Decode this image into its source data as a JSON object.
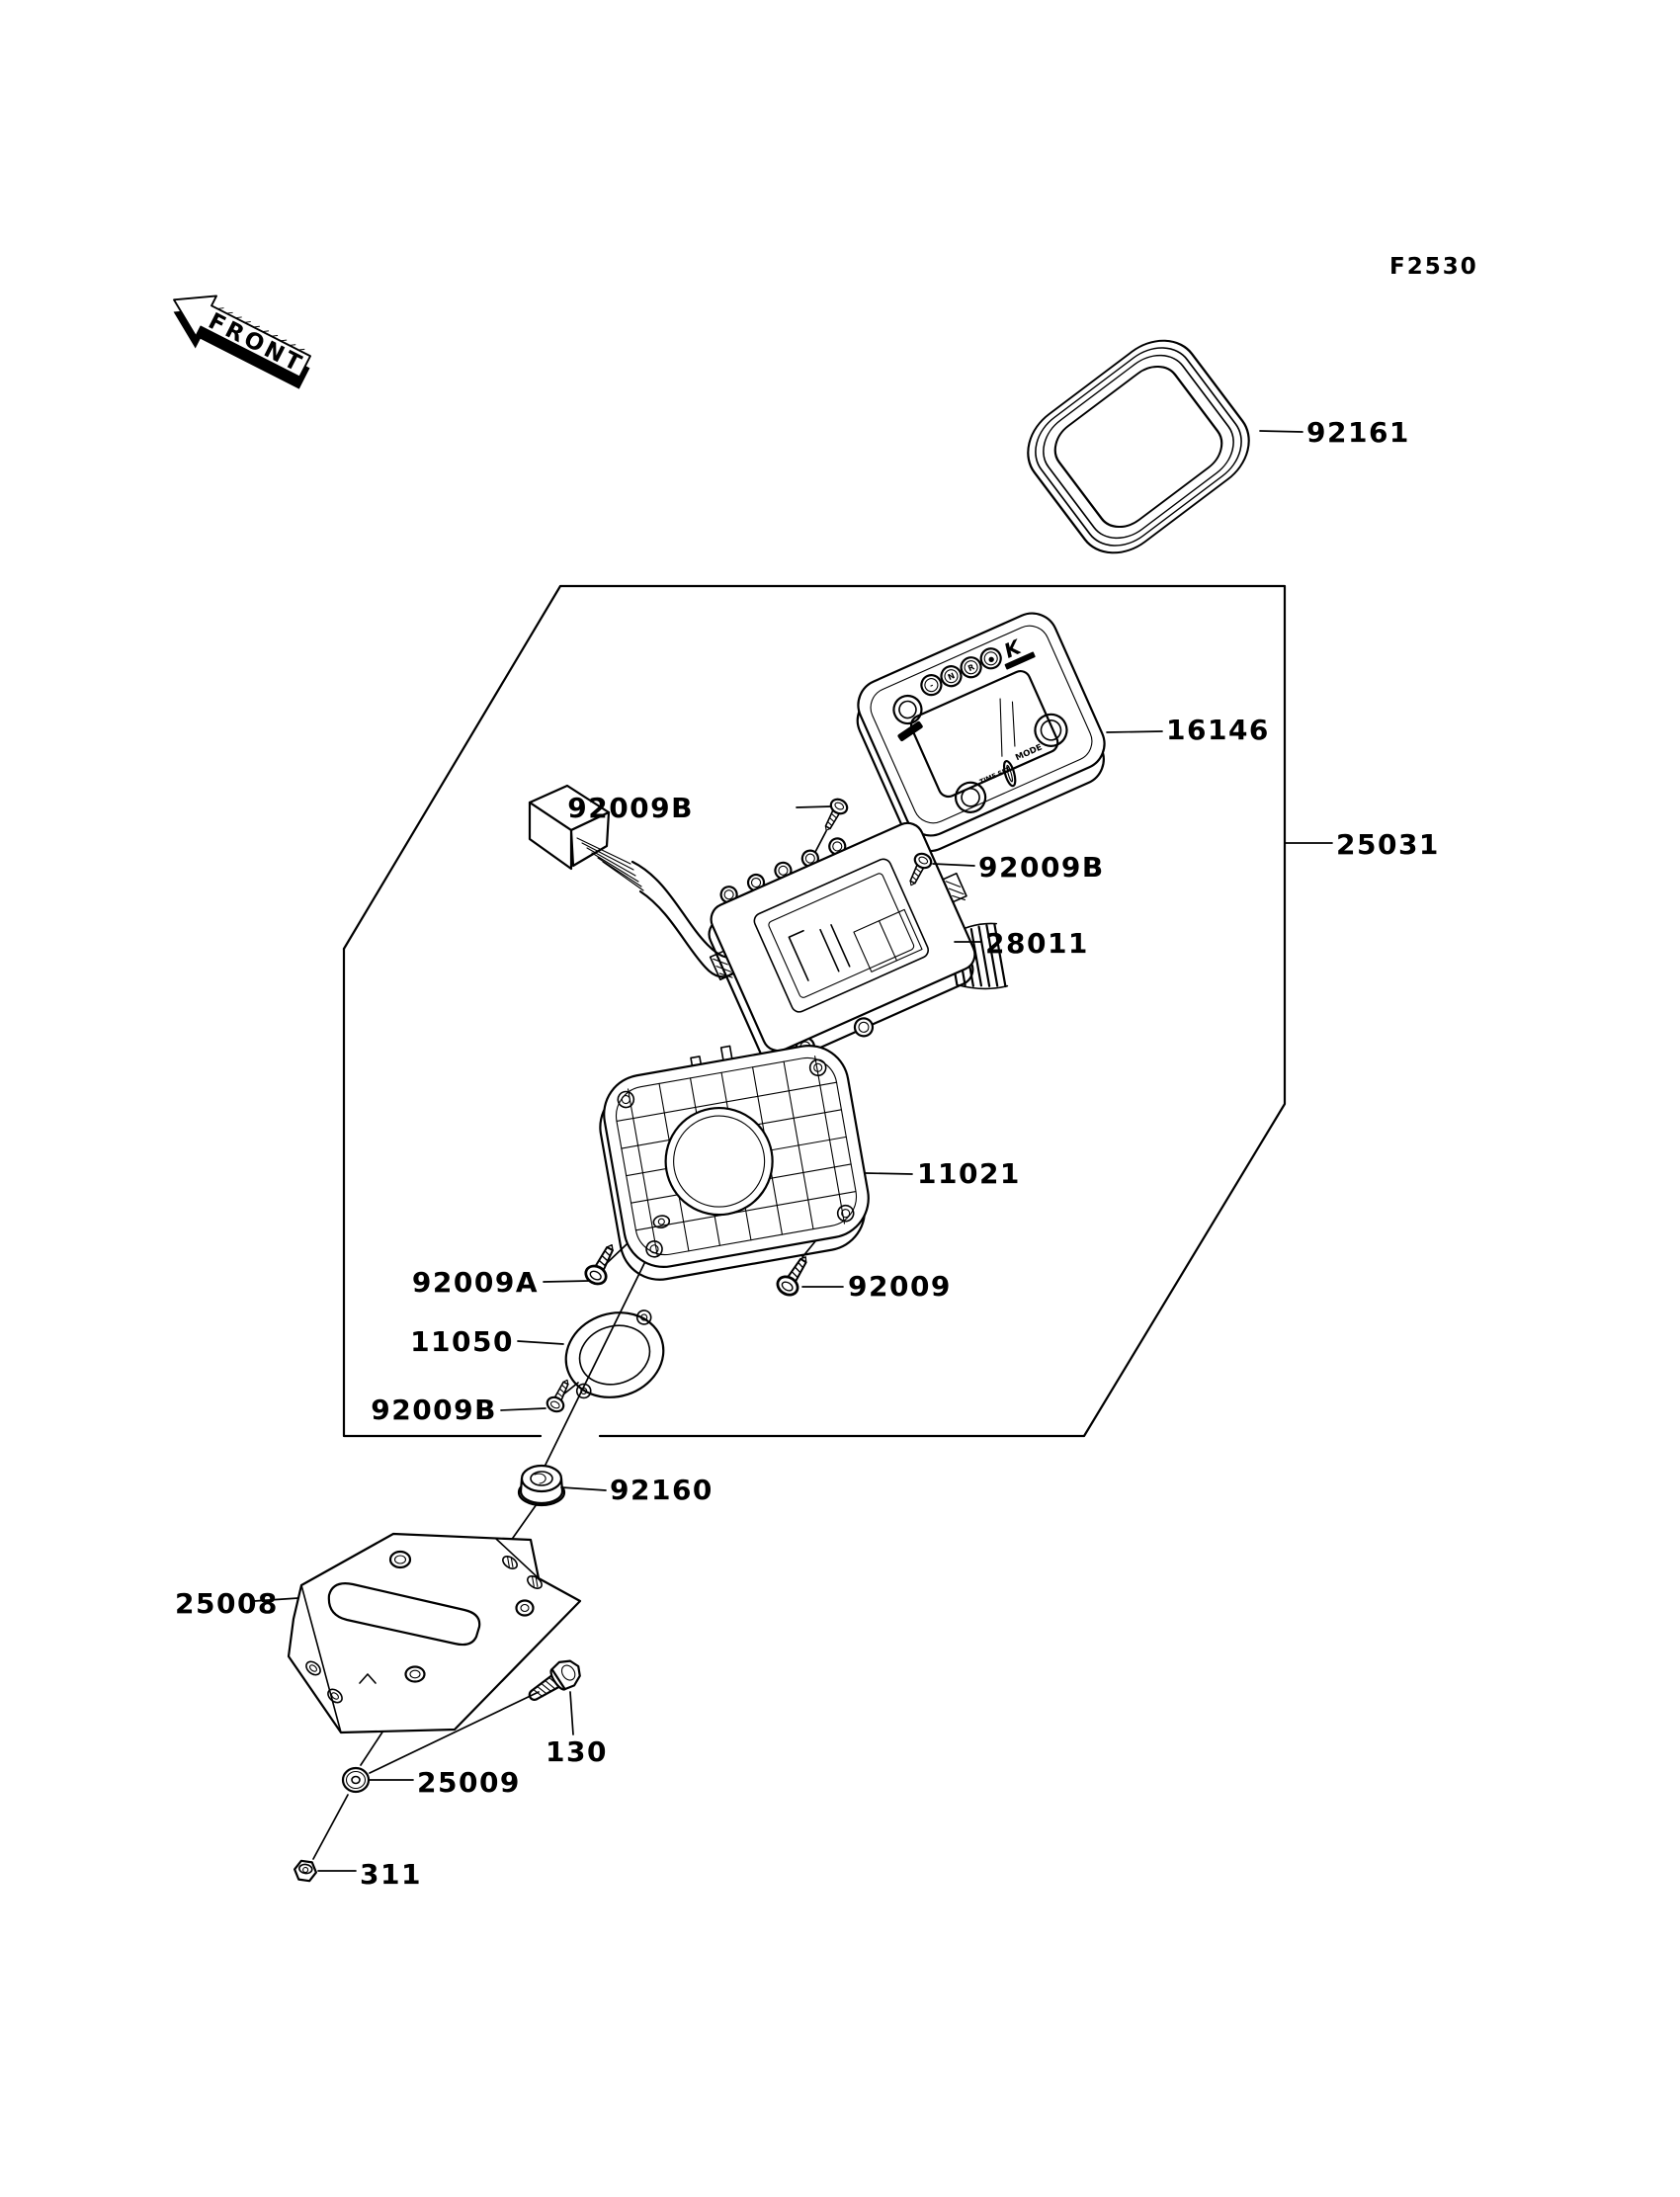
{
  "figure": {
    "code": "F2530",
    "front_marker": "FRONT"
  },
  "callouts": {
    "bezel": "92161",
    "meter_cover": "16146",
    "meter_assembly": "25031",
    "screw_b_top": "92009B",
    "screw_b_right": "92009B",
    "meter_body": "28011",
    "meter_case": "11021",
    "screw_a": "92009A",
    "screw": "92009",
    "ring": "11050",
    "screw_b_lower": "92009B",
    "damper": "92160",
    "bracket": "25008",
    "bolt": "130",
    "washer": "25009",
    "nut": "311"
  },
  "meter_face": {
    "brand_mark": "K",
    "indicator_lamps": [
      "-",
      "N",
      "R",
      "●"
    ],
    "left_button_label": "TIME SET",
    "right_button_label": "MODE"
  }
}
